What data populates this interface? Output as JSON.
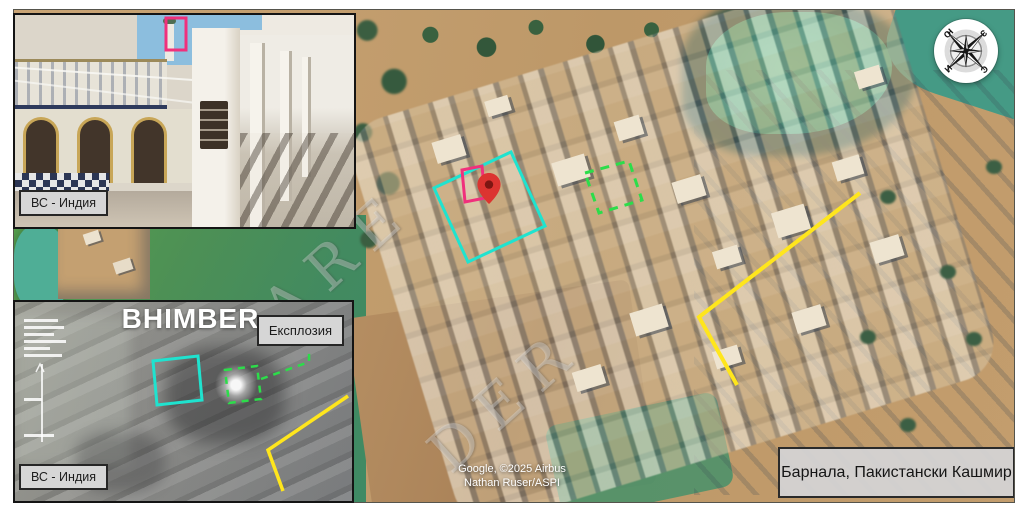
{
  "figure": {
    "location_label": "Барнала, Пакистански Кашмир",
    "attribution_line1": "Google, ©2025 Airbus",
    "attribution_line2": "Nathan Ruser/ASPI",
    "watermark_fragment1": "ARE",
    "watermark_fragment2": "DER"
  },
  "compass": {
    "north": "С",
    "east": "И",
    "south": "Ю",
    "west": "З"
  },
  "inset_photo": {
    "source_label": "ВС - Индия"
  },
  "inset_ir": {
    "title": "BHIMBER",
    "explosion_label": "Експлозия",
    "source_label": "ВС - Индия"
  },
  "annotations": {
    "cyan_box_color": "#1fe3cf",
    "pink_box_color": "#f0307c",
    "green_dashed_color": "#2cdd4a",
    "yellow_line_color": "#ffe61c",
    "pin_color": "#dc3430",
    "pin_core_color": "#7d1612",
    "crosshair_color": "rgba(255,255,255,0.85)"
  }
}
